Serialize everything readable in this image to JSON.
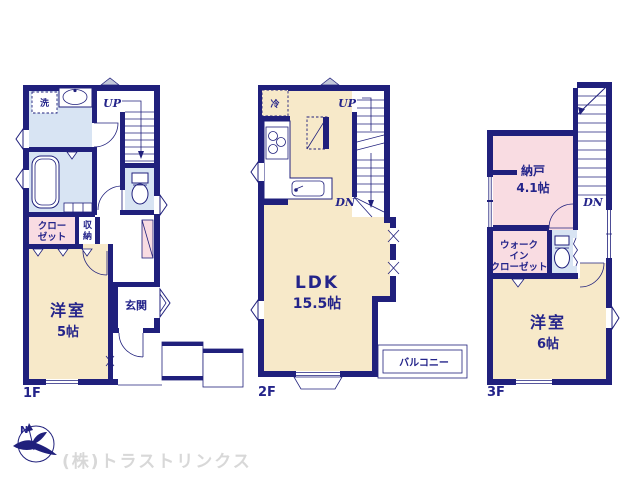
{
  "floor1": {
    "label": "1F",
    "laundry": "洗",
    "stairs_up": "UP",
    "closet_line1": "クロー",
    "closet_line2": "ゼット",
    "storage_char1": "収",
    "storage_char2": "納",
    "entrance": "玄関",
    "bedroom_name": "洋室",
    "bedroom_size": "5帖"
  },
  "floor2": {
    "label": "2F",
    "fridge": "冷",
    "stairs_up": "UP",
    "stairs_down": "DN",
    "ldk_name": "LDK",
    "ldk_size": "15.5帖",
    "balcony": "バルコニー"
  },
  "floor3": {
    "label": "3F",
    "stairs_down": "DN",
    "storeroom_name": "納戸",
    "storeroom_size": "4.1帖",
    "wic_line1": "ウォーク",
    "wic_line2": "イン",
    "wic_line3": "クローゼット",
    "bedroom_name": "洋室",
    "bedroom_size": "6帖"
  },
  "footer": {
    "compass_north": "N",
    "company_watermark": "(株)トラストリンクス"
  },
  "colors": {
    "wall_navy": "#20207c",
    "text_navy": "#24248a",
    "room_cream": "#f7e9c9",
    "room_pink": "#f9dce2",
    "room_blue": "#d8e4f3",
    "vent_gray": "#c2c7d9",
    "watermark_gray": "#d8d8d8"
  }
}
